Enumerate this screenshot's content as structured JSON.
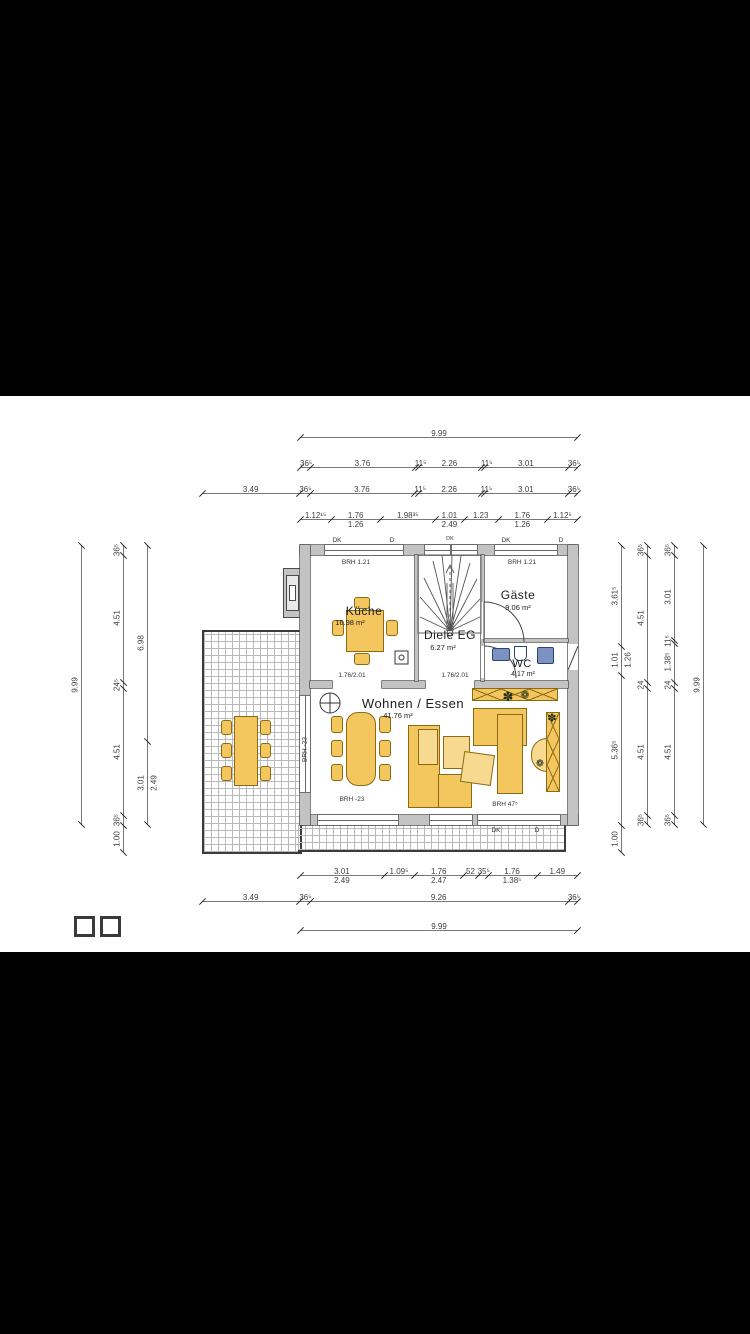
{
  "rooms": {
    "kueche": {
      "name": "Küche",
      "area": "16.98 m²"
    },
    "diele": {
      "name": "Diele EG",
      "area": "6.27 m²"
    },
    "gaeste": {
      "name": "Gäste",
      "area": "9.06 m²"
    },
    "wc": {
      "name": "WC",
      "area": "4.17 m²"
    },
    "wohnen": {
      "name": "Wohnen / Essen",
      "area": "41.76 m²"
    }
  },
  "labels": {
    "door_kueche": "1.76/2.01",
    "door_diele": "1.76/2.01",
    "sill_kueche": "BRH 1.21",
    "sill_gaeste": "BRH 1.21",
    "sill_left": "BRH -23",
    "sill_bottom": "BRH -23",
    "sill_bottom_right": "BRH 47⁵",
    "vent_dk": "DK",
    "vent_d": "D"
  },
  "icons": {
    "plant": "✽",
    "flower": "❁"
  },
  "colors": {
    "wall_fill": "#c3c3c3",
    "wall_edge": "#4a4a4a",
    "furniture": "#f3c65e",
    "fixture_blue": "#7b92c2",
    "paper": "#ffffff",
    "letterbox": "#000000"
  },
  "dims": {
    "t1": [
      {
        "v": "9.99",
        "w": 9.99
      }
    ],
    "t2": [
      {
        "v": "36⁵",
        "w": 0.365
      },
      {
        "v": "3.76",
        "w": 3.76
      },
      {
        "v": "11⁵",
        "w": 0.115
      },
      {
        "v": "2.26",
        "w": 2.26
      },
      {
        "v": "11⁵",
        "w": 0.115
      },
      {
        "v": "3.01",
        "w": 3.01
      },
      {
        "v": "36⁵",
        "w": 0.365
      }
    ],
    "t3": [
      {
        "v": "3.49",
        "w": 3.49
      },
      {
        "v": "36⁵",
        "w": 0.365
      },
      {
        "v": "3.76",
        "w": 3.76
      },
      {
        "v": "11⁵",
        "w": 0.115
      },
      {
        "v": "2.26",
        "w": 2.26
      },
      {
        "v": "11⁵",
        "w": 0.115
      },
      {
        "v": "3.01",
        "w": 3.01
      },
      {
        "v": "36⁵",
        "w": 0.365
      }
    ],
    "t4": [
      {
        "v": "1.12¹⁵",
        "w": 1.12
      },
      {
        "v": "1.76",
        "v2": "1.26",
        "w": 1.76
      },
      {
        "v": "1.98³⁵",
        "w": 1.98
      },
      {
        "v": "1.01",
        "v2": "2.49",
        "w": 1.01
      },
      {
        "v": "1.23",
        "w": 1.23
      },
      {
        "v": "1.76",
        "v2": "1.26",
        "w": 1.76
      },
      {
        "v": "1.12⁵",
        "w": 1.12
      }
    ],
    "b1": [
      {
        "v": "3.01",
        "v2": "2.49",
        "w": 3.01
      },
      {
        "v": "1.09⁵",
        "w": 1.095
      },
      {
        "v": "1.76",
        "v2": "2.47",
        "w": 1.76
      },
      {
        "v": "52",
        "w": 0.52
      },
      {
        "v": "35⁵",
        "w": 0.355
      },
      {
        "v": "1.76",
        "v2": "1.38⁵",
        "w": 1.76
      },
      {
        "v": "1.49",
        "w": 1.49
      }
    ],
    "b2": [
      {
        "v": "3.49",
        "w": 3.49
      },
      {
        "v": "36⁵",
        "w": 0.365
      },
      {
        "v": "9.26",
        "w": 9.26
      },
      {
        "v": "36⁵",
        "w": 0.365
      }
    ],
    "b3": [
      {
        "v": "9.99",
        "w": 9.99
      }
    ],
    "l1": [
      {
        "v": "9.99",
        "w": 9.99
      }
    ],
    "l2": [
      {
        "v": "36⁵",
        "w": 0.365
      },
      {
        "v": "4.51",
        "w": 4.51
      },
      {
        "v": "24⁵",
        "w": 0.245
      },
      {
        "v": "4.51",
        "w": 4.51
      },
      {
        "v": "36⁵",
        "w": 0.365
      },
      {
        "v": "1.00",
        "w": 1.0
      }
    ],
    "l3": [
      {
        "v": "6.98",
        "w": 6.98
      },
      {
        "v": "3.01",
        "v2": "2.49",
        "w": 3.01
      }
    ],
    "r1": [
      {
        "v": "3.61⁵",
        "w": 3.615
      },
      {
        "v": "1.01",
        "v2": "1.26",
        "w": 1.01
      },
      {
        "v": "5.36⁵",
        "w": 5.365
      },
      {
        "v": "1.00",
        "w": 1.0
      }
    ],
    "r2": [
      {
        "v": "36⁵",
        "w": 0.365
      },
      {
        "v": "4.51",
        "w": 4.51
      },
      {
        "v": "24",
        "w": 0.245
      },
      {
        "v": "4.51",
        "w": 4.51
      },
      {
        "v": "36⁵",
        "w": 0.365
      }
    ],
    "r3": [
      {
        "v": "36⁵",
        "w": 0.365
      },
      {
        "v": "3.01",
        "w": 3.01
      },
      {
        "v": "11⁵",
        "w": 0.115
      },
      {
        "v": "1.38⁵",
        "w": 1.385
      },
      {
        "v": "24",
        "w": 0.24
      },
      {
        "v": "4.51",
        "w": 4.51
      },
      {
        "v": "36⁵",
        "w": 0.365
      }
    ],
    "r4": [
      {
        "v": "9.99",
        "w": 9.99
      }
    ]
  }
}
